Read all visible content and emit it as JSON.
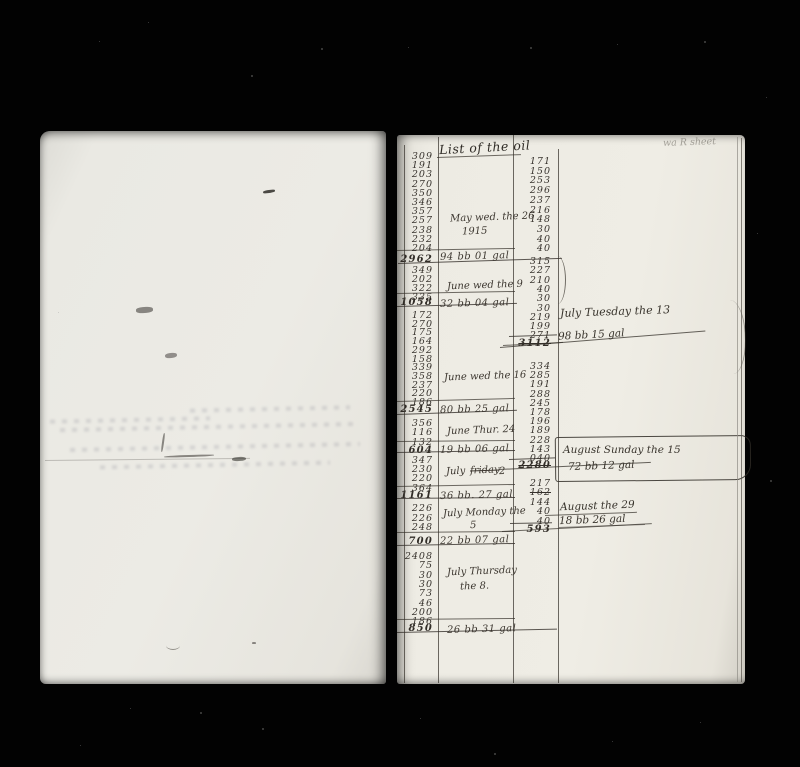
{
  "right_page": {
    "header": "List of the oil",
    "corner_note": "wa R sheet",
    "col1_groups": [
      {
        "entries": [
          "309",
          "191",
          "203",
          "270",
          "350",
          "346",
          "357",
          "257",
          "238",
          "232",
          "204"
        ],
        "total": "2962",
        "note": [
          "May wed. the 26",
          "1915"
        ],
        "gal": "94 bb 01 gal"
      },
      {
        "entries": [
          "349",
          "202",
          "322",
          "335"
        ],
        "total": "1058",
        "note": [
          "June wed the 9"
        ],
        "gal": "32 bb 04 gal"
      },
      {
        "entries": [
          "172",
          "270",
          "175",
          "164",
          "292",
          "158",
          "339",
          "358",
          "237",
          "220",
          "186"
        ],
        "total": "2545",
        "note": [
          "June wed the 16"
        ],
        "gal": "80 bb 25 gal"
      },
      {
        "entries": [
          "356",
          "116",
          "132"
        ],
        "total": "604",
        "note": [
          "June Thur. 24"
        ],
        "gal": "19 bb 06 gal"
      },
      {
        "entries": [
          "347",
          "230",
          "220",
          "364"
        ],
        "total": "1161",
        "note": [
          "July",
          "friday",
          "2"
        ],
        "gal": "36 bb. 27 gal"
      },
      {
        "entries": [
          "226",
          "226",
          "248"
        ],
        "total": "700",
        "note": [
          "July Monday the",
          "5"
        ],
        "gal": "22 bb 07 gal"
      },
      {
        "entries": [
          "2408",
          "75",
          "30",
          "30",
          "73",
          "46",
          "200",
          "186"
        ],
        "total": "850",
        "note": [
          "July Thursday",
          "the 8."
        ],
        "gal": "26 bb 31 gal"
      }
    ],
    "col2_groups": [
      {
        "entries": [
          "171",
          "150",
          "253",
          "296",
          "237",
          "216",
          "148",
          "30",
          "40",
          "40"
        ],
        "total": ""
      },
      {
        "entries": [
          "315",
          "227",
          "210",
          "40",
          "30",
          "30",
          "219",
          "199",
          "271"
        ],
        "total": "3112",
        "total_struck": true
      },
      {
        "entries": [
          "334",
          "285",
          "191",
          "288",
          "245",
          "178",
          "196",
          "189",
          "228",
          "143",
          "040"
        ],
        "total": "2280",
        "total_struck": true
      },
      {
        "entries": [
          "217",
          "162",
          "144",
          "40",
          "40"
        ],
        "total": "593",
        "struck_entries": [
          1
        ]
      }
    ],
    "margin_notes": {
      "july13_line1": "July Tuesday the 13",
      "july13_line2": "98 bb 15 gal",
      "aug15_line1": "August Sunday the 15",
      "aug15_line2": "72 bb 12 gal",
      "aug29_line1": "August the 29",
      "aug29_line2": "18 bb 26 gal"
    }
  }
}
